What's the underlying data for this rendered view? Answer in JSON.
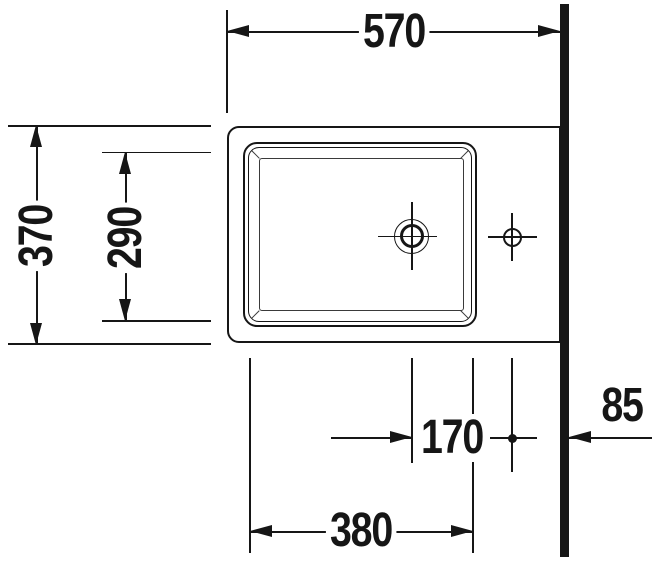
{
  "dimensions": {
    "overall_width": "570",
    "overall_depth": "370",
    "basin_inner_depth": "290",
    "basin_inner_width": "380",
    "drain_to_faucet": "170",
    "faucet_to_wall": "85"
  },
  "colors": {
    "line": "#161616",
    "background": "#ffffff"
  }
}
